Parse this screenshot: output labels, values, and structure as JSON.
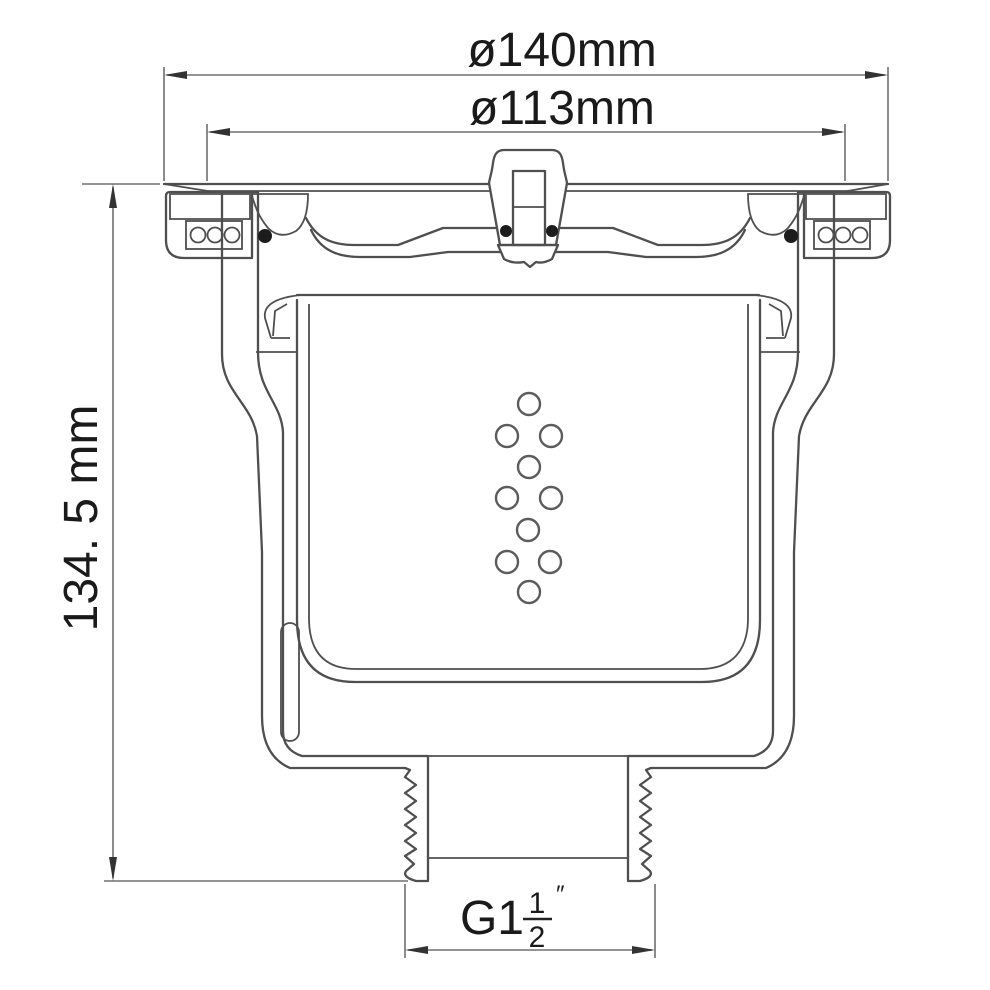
{
  "drawing": {
    "type": "technical-cross-section",
    "subject": "floor drain with strainer bucket and threaded outlet"
  },
  "colors": {
    "background": "#ffffff",
    "drawing_line": "#4f4f4f",
    "dimension_line": "#707070",
    "text": "#1a1a1a"
  },
  "dimensions": {
    "outer_diameter": {
      "label": "ø140mm"
    },
    "inner_diameter": {
      "label": "ø113mm"
    },
    "overall_height": {
      "label": "134. 5 mm"
    },
    "outlet_thread": {
      "prefix": "G1",
      "fraction_numerator": "1",
      "fraction_denominator": "2",
      "inch_mark": "″"
    }
  }
}
